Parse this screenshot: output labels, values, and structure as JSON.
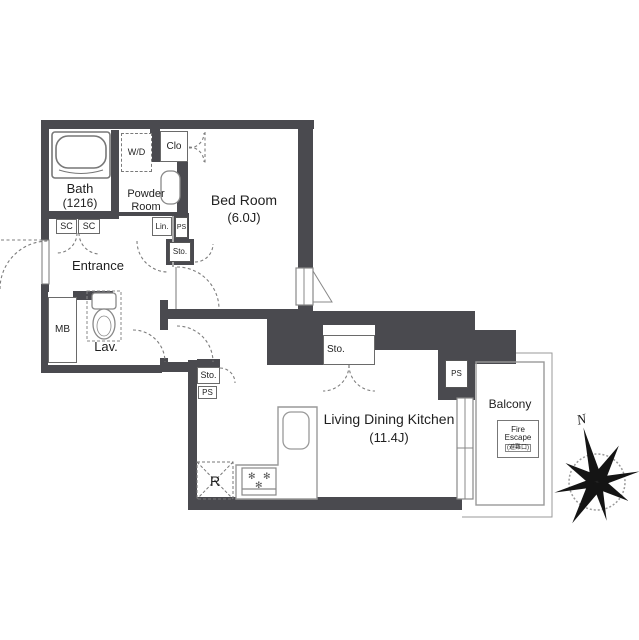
{
  "rooms": {
    "bath": {
      "name": "Bath",
      "size": "(1216)"
    },
    "powder": {
      "line1": "Powder",
      "line2": "Room"
    },
    "bedroom": {
      "name": "Bed Room",
      "size": "(6.0J)"
    },
    "entrance": {
      "name": "Entrance"
    },
    "lav": {
      "name": "Lav."
    },
    "ldk": {
      "name": "Living Dining Kitchen",
      "size": "(11.4J)"
    },
    "balcony": {
      "name": "Balcony"
    }
  },
  "labels": {
    "wd": "W/D",
    "clo": "Clo",
    "sc1": "SC",
    "sc2": "SC",
    "lin": "Lin.",
    "ps_powder": "PS",
    "sto_hall": "Sto.",
    "mb": "MB",
    "sto_ldk": "Sto.",
    "ps_ldk": "PS",
    "sto_top": "Sto.",
    "ps_right": "PS",
    "fridge": "R",
    "compass_n": "N"
  },
  "fire_escape": {
    "line1": "Fire",
    "line2": "Escape",
    "line3": "(避難口)"
  },
  "stove_burner_glyph": "✻",
  "colors": {
    "wall": "#4a4a4f",
    "line": "#8a8a8a",
    "text": "#1f1f1f"
  }
}
